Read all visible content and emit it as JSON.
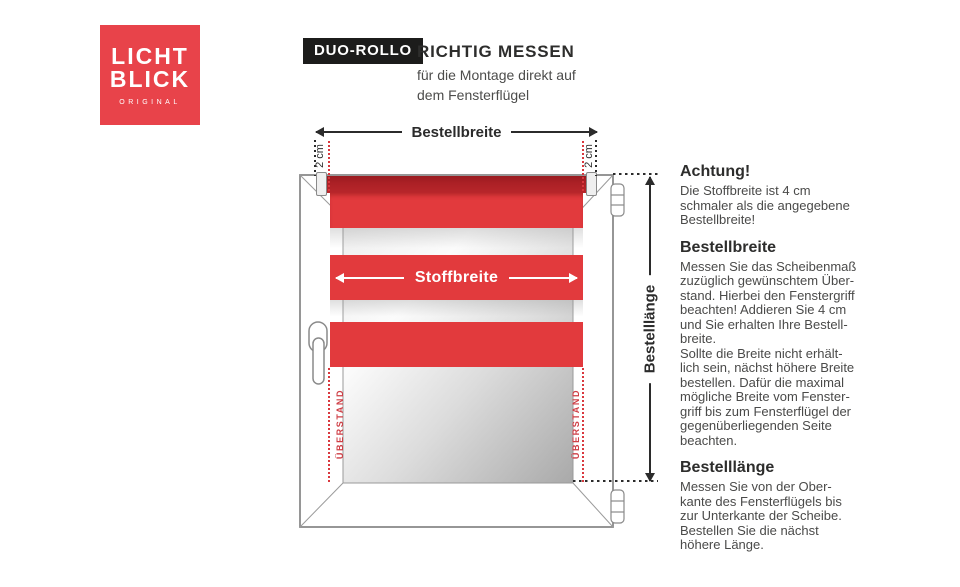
{
  "brand": {
    "line1": "LICHT",
    "line2": "BLICK",
    "sub": "ORIGINAL"
  },
  "header": {
    "badge": "DUO-ROLLO",
    "title": "RICHTIG MESSEN",
    "subtitle": "für die Montage direkt auf\ndem Fensterflügel"
  },
  "diagram": {
    "bestellbreite_label": "Bestellbreite",
    "stoffbreite_label": "Stoffbreite",
    "bestelllaenge_label": "Bestelllänge",
    "offset_left_label": "2 cm",
    "offset_right_label": "2 cm",
    "overhang_left_label": "ÜBERSTAND",
    "overhang_right_label": "ÜBERSTAND",
    "colors": {
      "brand_red": "#e8434a",
      "fabric_red": "#e23a3d",
      "cassette_red": "#ab2025",
      "dotted_red": "#d9383e",
      "badge_black": "#1c1c1b"
    }
  },
  "info": {
    "sections": [
      {
        "heading": "Achtung!",
        "body": "Die Stoffbreite ist 4 cm\nschmaler als die angegebene\nBestellbreite!"
      },
      {
        "heading": "Bestellbreite",
        "body": "Messen Sie das Scheibenmaß\nzuzüglich gewünschtem Über-\nstand. Hierbei den Fenstergriff\nbeachten! Addieren Sie 4 cm\nund Sie erhalten Ihre Bestell-\nbreite.\nSollte die Breite nicht erhält-\nlich sein, nächst höhere Breite\nbestellen. Dafür die maximal\nmögliche Breite vom Fenster-\ngriff bis zum Fensterflügel der\ngegenüberliegenden Seite\nbeachten."
      },
      {
        "heading": "Bestelllänge",
        "body": "Messen Sie von der Ober-\nkante des Fensterflügels bis\nzur Unterkante der Scheibe.\nBestellen Sie die nächst\nhöhere Länge."
      }
    ]
  }
}
